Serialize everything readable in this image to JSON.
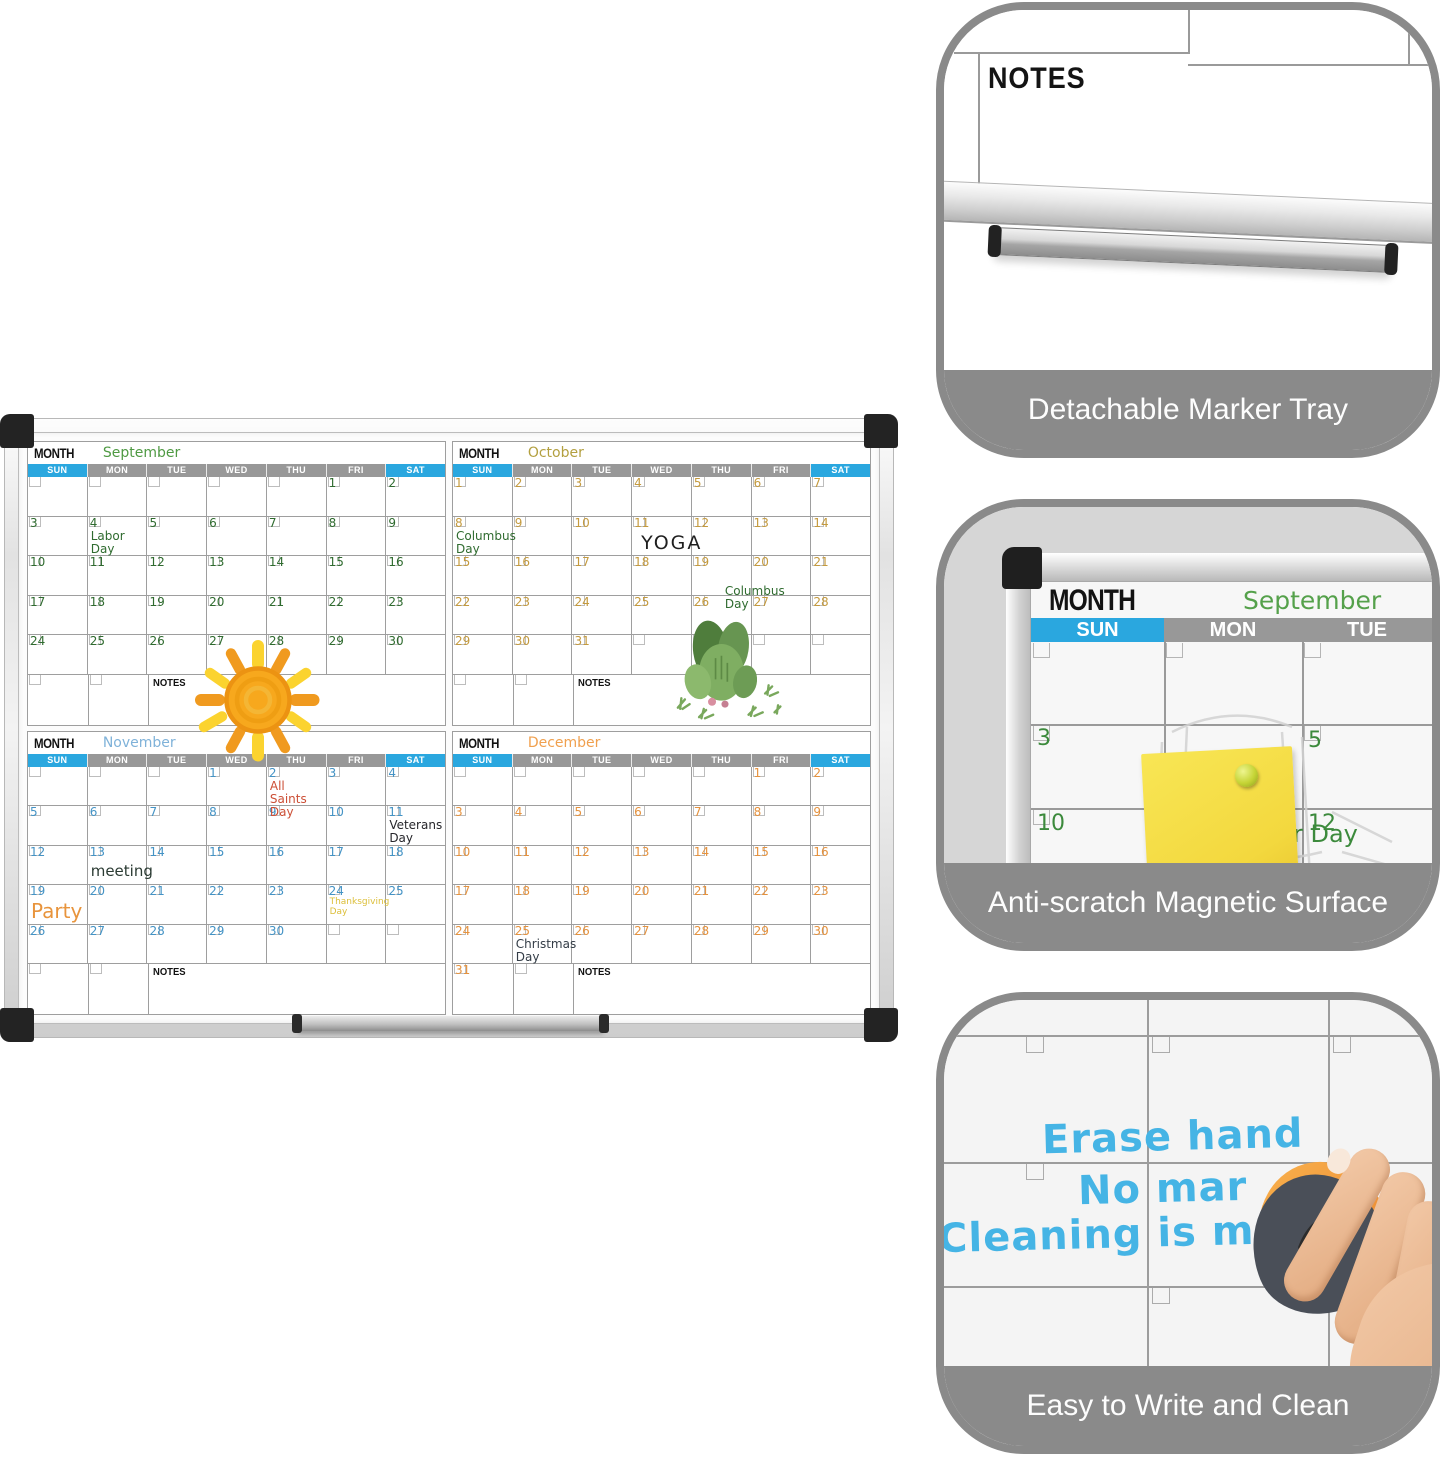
{
  "colors": {
    "header_blue": "#2aa7df",
    "header_gray": "#989898",
    "panel_gray": "#8a8a8a",
    "marker_blue": "#45b4e5",
    "eraser_orange": "#f0953a",
    "sticky_yellow": "#f5dd4a",
    "sticky_pink": "#f0c7d5",
    "pin_green": "#c5d435",
    "pin_magenta": "#e22ba0"
  },
  "weekdays": [
    "SUN",
    "MON",
    "TUE",
    "WED",
    "THU",
    "FRI",
    "SAT"
  ],
  "calendars": [
    {
      "name": "september",
      "title_label": "MONTH",
      "month_name": "September",
      "title_color": "#4f9a43",
      "number_color": "#2f6b2f",
      "weeks": [
        [
          "",
          "",
          "",
          "",
          "",
          "1",
          "2"
        ],
        [
          "3",
          "4",
          "5",
          "6",
          "7",
          "8",
          "9"
        ],
        [
          "10",
          "11",
          "12",
          "13",
          "14",
          "15",
          "16"
        ],
        [
          "17",
          "18",
          "19",
          "20",
          "21",
          "22",
          "23"
        ],
        [
          "24",
          "25",
          "26",
          "27",
          "28",
          "29",
          "30"
        ]
      ],
      "last_row": {
        "cells": [
          "",
          ""
        ],
        "label": "NOTES"
      },
      "annotations": [
        {
          "day": "4",
          "text": "Labor Day",
          "color": "#2f6b2f",
          "size": 12
        }
      ],
      "drawings": [
        "sun-doodle"
      ]
    },
    {
      "name": "october",
      "title_label": "MONTH",
      "month_name": "October",
      "title_color": "#b3a040",
      "number_color": "#c49a3e",
      "weeks": [
        [
          "1",
          "2",
          "3",
          "4",
          "5",
          "6",
          "7"
        ],
        [
          "8",
          "9",
          "10",
          "11",
          "12",
          "13",
          "14"
        ],
        [
          "15",
          "16",
          "17",
          "18",
          "19",
          "20",
          "21"
        ],
        [
          "22",
          "23",
          "24",
          "25",
          "26",
          "27",
          "28"
        ],
        [
          "29",
          "30",
          "31",
          "",
          "",
          "",
          ""
        ]
      ],
      "last_row": {
        "cells": [
          "",
          ""
        ],
        "label": "NOTES"
      },
      "annotations": [
        {
          "day": "8",
          "text": "Columbus\nDay",
          "color": "#2f6b2f",
          "size": 12
        },
        {
          "day": "11",
          "text": "YOGA",
          "color": "#1f1f1f",
          "size": 19,
          "dx": 6,
          "dy": 3,
          "spaced": true
        },
        {
          "day": "19",
          "text": "Columbus\nDay",
          "color": "#2f6b2f",
          "size": 12,
          "pos": "bottom",
          "dx": 30
        }
      ],
      "drawings": [
        "cactus-sticker"
      ]
    },
    {
      "name": "november",
      "title_label": "MONTH",
      "month_name": "November",
      "title_color": "#7fb2d9",
      "number_color": "#4493c5",
      "weeks": [
        [
          "",
          "",
          "",
          "1",
          "2",
          "3",
          "4"
        ],
        [
          "5",
          "6",
          "7",
          "8",
          "9",
          "10",
          "11"
        ],
        [
          "12",
          "13",
          "14",
          "15",
          "16",
          "17",
          "18"
        ],
        [
          "19",
          "20",
          "21",
          "22",
          "23",
          "24",
          "25"
        ],
        [
          "26",
          "27",
          "28",
          "29",
          "30",
          "",
          ""
        ]
      ],
      "last_row": {
        "cells": [
          "",
          ""
        ],
        "label": "NOTES"
      },
      "annotations": [
        {
          "day": "2",
          "text": "All\nSaints\nDay",
          "color": "#cc4f36",
          "size": 12
        },
        {
          "day": "11",
          "text": "Veterans\nDay",
          "color": "#26262b",
          "size": 12
        },
        {
          "day": "13",
          "text": "meeting",
          "color": "#2b3b33",
          "size": 15,
          "dy": 4
        },
        {
          "day": "19",
          "text": "Party",
          "color": "#e8943c",
          "size": 20,
          "dy": 2
        },
        {
          "day": "24",
          "text": "Thanksgiving\nDay",
          "color": "#dcbf3a",
          "size": 9
        }
      ],
      "drawings": []
    },
    {
      "name": "december",
      "title_label": "MONTH",
      "month_name": "December",
      "title_color": "#f0a04e",
      "number_color": "#e5923e",
      "weeks": [
        [
          "",
          "",
          "",
          "",
          "",
          "1",
          "2"
        ],
        [
          "3",
          "4",
          "5",
          "6",
          "7",
          "8",
          "9"
        ],
        [
          "10",
          "11",
          "12",
          "13",
          "14",
          "15",
          "16"
        ],
        [
          "17",
          "18",
          "19",
          "20",
          "21",
          "22",
          "23"
        ],
        [
          "24",
          "25",
          "26",
          "27",
          "28",
          "29",
          "30"
        ]
      ],
      "last_row": {
        "cells": [
          "31",
          ""
        ],
        "label": "NOTES"
      },
      "annotations": [
        {
          "day": "25",
          "text": "Christmas\nDay",
          "color": "#333c46",
          "size": 12
        }
      ],
      "drawings": []
    }
  ],
  "panels": [
    {
      "caption": "Detachable Marker Tray",
      "notes_label": "NOTES"
    },
    {
      "caption": "Anti-scratch Magnetic Surface",
      "month_label": "MONTH",
      "month_name": "September",
      "weekdays_visible": [
        "SUN",
        "MON",
        "TUE"
      ],
      "day_numbers": [
        "3",
        "5",
        "10",
        "12"
      ],
      "handwriting_visible": "r Day"
    },
    {
      "caption": "Easy to Write and Clean",
      "marker_lines": [
        "Erase hand",
        "No mar",
        "Cleaning is m"
      ]
    }
  ]
}
